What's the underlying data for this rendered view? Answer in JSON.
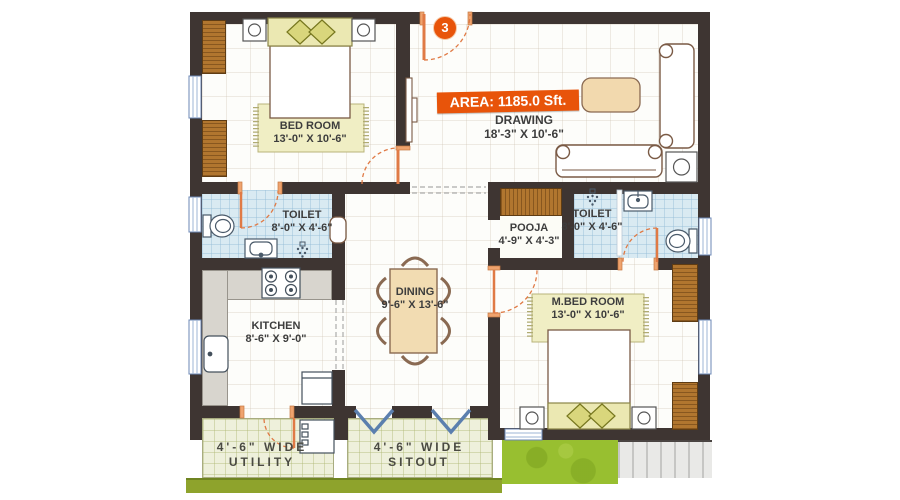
{
  "plan": {
    "marker": "3",
    "area_banner": "AREA: 1185.0 Sft.",
    "rooms": {
      "bedroom": {
        "name": "BED ROOM",
        "dims": "13'-0\" X 10'-6\""
      },
      "drawing": {
        "name": "DRAWING",
        "dims": "18'-3\" X 10'-6\""
      },
      "toilet_left": {
        "name": "TOILET",
        "dims": "8'-0\" X 4'-6\""
      },
      "pooja": {
        "name": "POOJA",
        "dims": "4'-9\" X 4'-3\""
      },
      "toilet_right": {
        "name": "TOILET",
        "dims": "8'-0\" X 4'-6\""
      },
      "kitchen": {
        "name": "KITCHEN",
        "dims": "8'-6\" X 9'-0\""
      },
      "dining": {
        "name": "DINING",
        "dims": "9'-6\" X 13'-6\""
      },
      "master_bedroom": {
        "name": "M.BED ROOM",
        "dims": "13'-0\" X 10'-6\""
      },
      "utility": {
        "line1": "4'-6\" WIDE",
        "line2": "UTILITY"
      },
      "sitout": {
        "line1": "4'-6\" WIDE",
        "line2": "SITOUT"
      }
    },
    "colors": {
      "accent": "#E8540A",
      "wall": "#3E3532",
      "wood": "#B1762F",
      "toilet_floor": "#D9EAF2",
      "utility_floor": "#EEF0DB",
      "grass": "#98BF30",
      "door": "#E07A45",
      "window_frame": "#6B87B5"
    }
  }
}
